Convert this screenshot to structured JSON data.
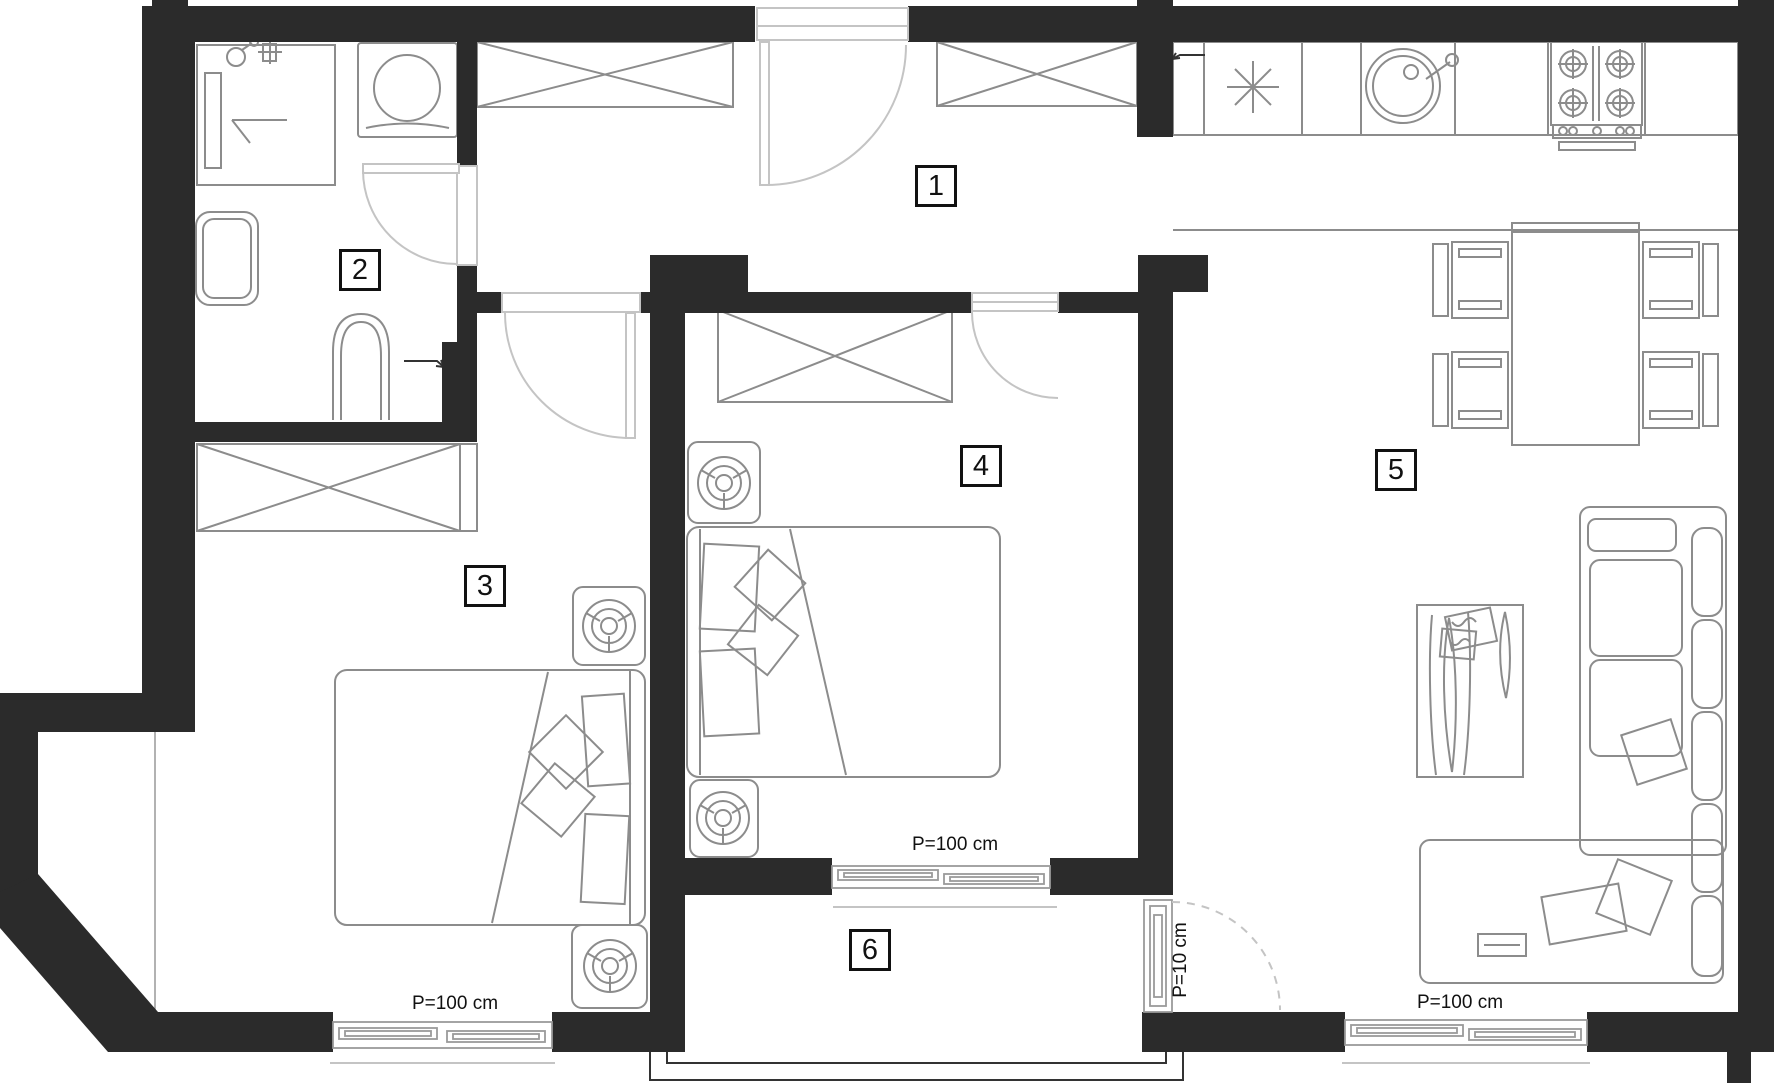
{
  "colors": {
    "background": "#ffffff",
    "wall": "#2b2b2b",
    "furniture_line": "#8c8c8c",
    "door_line": "#c4c4c4",
    "text": "#111111"
  },
  "rooms": [
    {
      "number": "1"
    },
    {
      "number": "2"
    },
    {
      "number": "3"
    },
    {
      "number": "4"
    },
    {
      "number": "5"
    },
    {
      "number": "6"
    }
  ],
  "window_labels": {
    "left": "P=100 cm",
    "middle": "P=100 cm",
    "right": "P=100 cm",
    "balcony_door": "P=10 cm"
  }
}
